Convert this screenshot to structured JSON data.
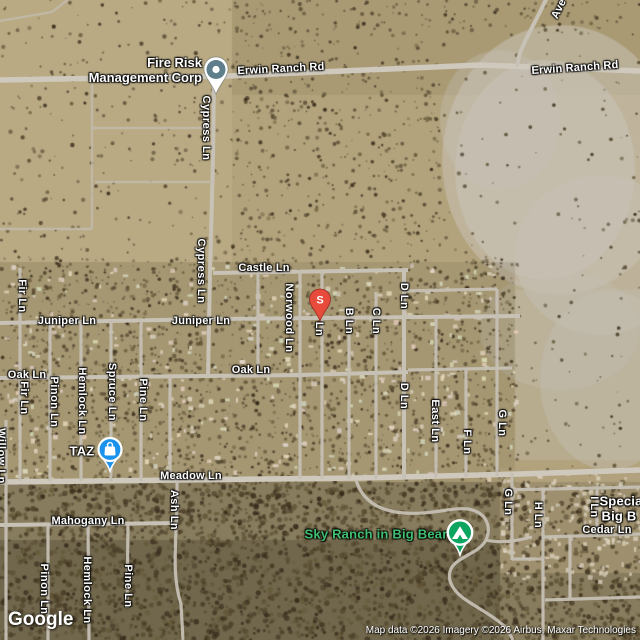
{
  "branding": {
    "logo_text": "Google",
    "attribution": "Map data ©2026 Imagery ©2026 Airbus, Maxar Technologies"
  },
  "poi": {
    "fire_risk": {
      "line1": "Fire Risk",
      "line2": "Management Corp"
    },
    "s_pin": {
      "label": "S"
    }
  },
  "colors": {
    "pin_red": "#E74B3C",
    "marker_blue": "#1B93EC",
    "marker_green": "#0CA55F",
    "pin_slate": "#5F7E8C",
    "park_label_green": "#3FBF6F",
    "road_gray": "#C8C2B6"
  },
  "labels": [
    {
      "name": "road-label-erwin-ranch-rd-west",
      "text": "Erwin Ranch Rd",
      "x": 281,
      "y": 69,
      "o": "h",
      "kind": "road",
      "rot": -3
    },
    {
      "name": "road-label-erwin-ranch-rd-east",
      "text": "Erwin Ranch Rd",
      "x": 575,
      "y": 68,
      "o": "h",
      "kind": "road",
      "rot": -4
    },
    {
      "name": "road-label-ave-partial",
      "text": "Ave",
      "x": 559,
      "y": 9,
      "o": "h",
      "kind": "road",
      "rot": -64
    },
    {
      "name": "road-label-castle-ln",
      "text": "Castle Ln",
      "x": 264,
      "y": 268,
      "o": "h",
      "kind": "road"
    },
    {
      "name": "road-label-juniper-ln-west",
      "text": "Juniper Ln",
      "x": 67,
      "y": 321,
      "o": "h",
      "kind": "road"
    },
    {
      "name": "road-label-juniper-ln-east",
      "text": "Juniper Ln",
      "x": 201,
      "y": 321,
      "o": "h",
      "kind": "road"
    },
    {
      "name": "road-label-oak-ln-west",
      "text": "Oak Ln",
      "x": 27,
      "y": 375,
      "o": "h",
      "kind": "road"
    },
    {
      "name": "road-label-oak-ln-east",
      "text": "Oak Ln",
      "x": 251,
      "y": 370,
      "o": "h",
      "kind": "road"
    },
    {
      "name": "road-label-meadow-ln",
      "text": "Meadow Ln",
      "x": 191,
      "y": 476,
      "o": "h",
      "kind": "road"
    },
    {
      "name": "road-label-mahogany-ln",
      "text": "Mahogany Ln",
      "x": 88,
      "y": 521,
      "o": "h",
      "kind": "road"
    },
    {
      "name": "road-label-cedar-ln",
      "text": "Cedar Ln",
      "x": 607,
      "y": 530,
      "o": "h",
      "kind": "road"
    },
    {
      "name": "road-label-cypress-ln-north",
      "text": "Cypress Ln",
      "x": 206,
      "y": 128,
      "o": "v",
      "kind": "road"
    },
    {
      "name": "road-label-cypress-ln-south",
      "text": "Cypress Ln",
      "x": 201,
      "y": 271,
      "o": "v",
      "kind": "road"
    },
    {
      "name": "road-label-fir-ln-north",
      "text": "Fir Ln",
      "x": 22,
      "y": 296,
      "o": "v",
      "kind": "road"
    },
    {
      "name": "road-label-norwood-ln",
      "text": "Norwood Ln",
      "x": 289,
      "y": 318,
      "o": "v",
      "kind": "road"
    },
    {
      "name": "road-label-a-ln-partial",
      "text": "Ln",
      "x": 319,
      "y": 329,
      "o": "v",
      "kind": "road"
    },
    {
      "name": "road-label-b-ln",
      "text": "B Ln",
      "x": 349,
      "y": 321,
      "o": "v",
      "kind": "road"
    },
    {
      "name": "road-label-c-ln",
      "text": "C Ln",
      "x": 376,
      "y": 321,
      "o": "v",
      "kind": "road"
    },
    {
      "name": "road-label-d-ln-north",
      "text": "D Ln",
      "x": 404,
      "y": 296,
      "o": "v",
      "kind": "road"
    },
    {
      "name": "road-label-d-ln-south",
      "text": "D Ln",
      "x": 404,
      "y": 396,
      "o": "v",
      "kind": "road"
    },
    {
      "name": "road-label-east-ln",
      "text": "East Ln",
      "x": 435,
      "y": 421,
      "o": "v",
      "kind": "road"
    },
    {
      "name": "road-label-f-ln",
      "text": "F Ln",
      "x": 467,
      "y": 442,
      "o": "v",
      "kind": "road"
    },
    {
      "name": "road-label-g-ln-north",
      "text": "G Ln",
      "x": 502,
      "y": 423,
      "o": "v",
      "kind": "road"
    },
    {
      "name": "road-label-g-ln-south",
      "text": "G Ln",
      "x": 508,
      "y": 502,
      "o": "v",
      "kind": "road"
    },
    {
      "name": "road-label-h-ln",
      "text": "H Ln",
      "x": 538,
      "y": 515,
      "o": "v",
      "kind": "road"
    },
    {
      "name": "road-label-i-ln",
      "text": "I Ln",
      "x": 594,
      "y": 507,
      "o": "v",
      "kind": "road"
    },
    {
      "name": "road-label-fir-ln-south",
      "text": "Fir Ln",
      "x": 24,
      "y": 398,
      "o": "v",
      "kind": "road"
    },
    {
      "name": "road-label-pinon-ln-north",
      "text": "Pinon Ln",
      "x": 54,
      "y": 402,
      "o": "v",
      "kind": "road"
    },
    {
      "name": "road-label-hemlock-ln-north",
      "text": "Hemlock Ln",
      "x": 82,
      "y": 401,
      "o": "v",
      "kind": "road"
    },
    {
      "name": "road-label-spruce-ln",
      "text": "Spruce Ln",
      "x": 112,
      "y": 392,
      "o": "v",
      "kind": "road"
    },
    {
      "name": "road-label-pine-ln-north",
      "text": "Pine Ln",
      "x": 143,
      "y": 400,
      "o": "v",
      "kind": "road"
    },
    {
      "name": "road-label-ash-ln",
      "text": "Ash Ln",
      "x": 174,
      "y": 510,
      "o": "v",
      "kind": "road"
    },
    {
      "name": "road-label-pinon-ln-south",
      "text": "Pinon Ln",
      "x": 44,
      "y": 589,
      "o": "v",
      "kind": "road"
    },
    {
      "name": "road-label-hemlock-ln-south",
      "text": "Hemlock Ln",
      "x": 87,
      "y": 590,
      "o": "v",
      "kind": "road"
    },
    {
      "name": "road-label-pine-ln-south",
      "text": "Pine Ln",
      "x": 128,
      "y": 586,
      "o": "v",
      "kind": "road"
    },
    {
      "name": "road-label-willow-ln-clipped",
      "text": "Willow Ln",
      "x": 1,
      "y": 456,
      "o": "v",
      "kind": "road"
    },
    {
      "name": "place-label-taz",
      "text": "TAZ",
      "x": 82,
      "y": 451,
      "o": "h",
      "kind": "place"
    },
    {
      "name": "place-label-special-line1-clipped",
      "text": "Specia",
      "x": 621,
      "y": 501,
      "o": "h",
      "kind": "place"
    },
    {
      "name": "place-label-special-line2-clipped",
      "text": "Big B",
      "x": 619,
      "y": 516,
      "o": "h",
      "kind": "place"
    },
    {
      "name": "park-label-sky-ranch",
      "text": "Sky Ranch in Big Bear",
      "x": 376,
      "y": 534,
      "o": "h",
      "kind": "park"
    }
  ]
}
